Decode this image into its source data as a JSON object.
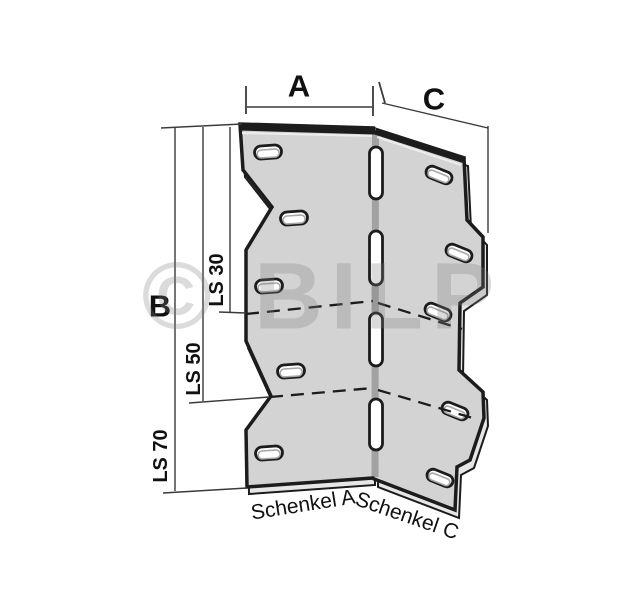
{
  "diagram": {
    "watermark_text": "© BILP",
    "dimension_labels": {
      "width_a": "A",
      "height_b": "B",
      "width_c": "C",
      "length_ls30": "LS 30",
      "length_ls50": "LS 50",
      "length_ls70": "LS 70"
    },
    "part_labels": {
      "leg_a": "Schenkel A",
      "leg_c": "Schenkel C"
    },
    "colors": {
      "bg": "#ffffff",
      "plate_fill": "#d3d3d3",
      "plate_edge_fill": "#e6e6e6",
      "fold_color": "#a2a2a2",
      "outline_color": "#1c1c1c",
      "dim_color": "#3a3a3a",
      "slot_fill": "#ffffff",
      "slot_inner": "#a8a8a8",
      "label_color": "#111111",
      "watermark_color": "rgba(125,125,125,0.28)"
    }
  }
}
